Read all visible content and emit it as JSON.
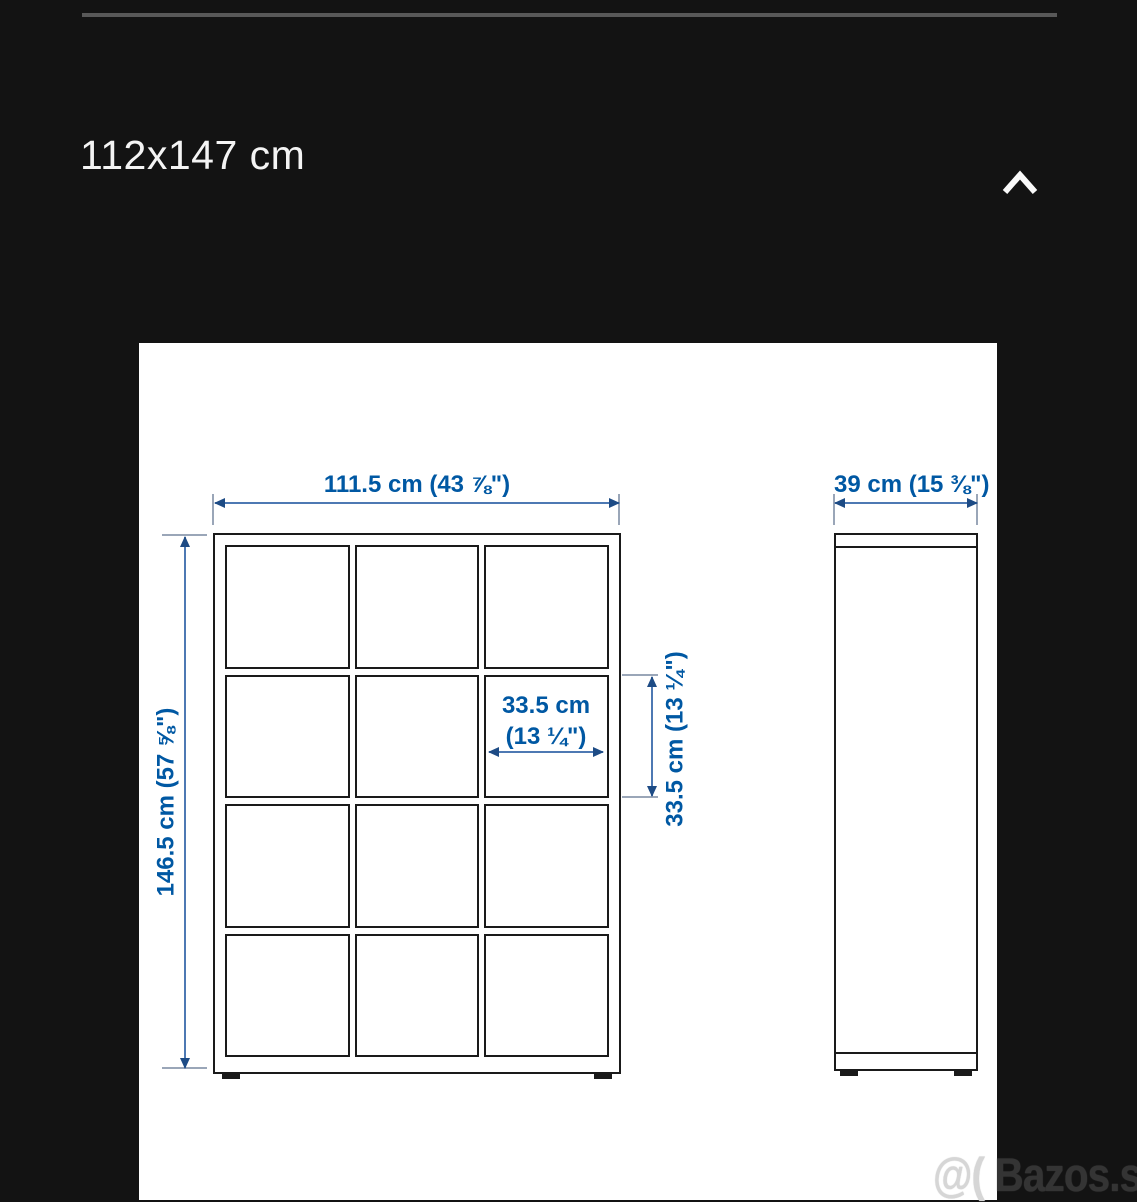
{
  "page": {
    "background_color": "#131313",
    "size_label": "112x147 cm"
  },
  "toolbar": {
    "collapse_icon": "chevron-up"
  },
  "diagram": {
    "dimension_text_color": "#0058a3",
    "drawing_line_color": "#1a1a1a",
    "front_view": {
      "columns": 3,
      "rows": 4,
      "width_label": "111.5 cm (43 ⅞\")",
      "height_label": "146.5 cm (57 ⅝\")",
      "cell_width_label_line1": "33.5 cm",
      "cell_width_label_line2": "(13 ¼\")",
      "cell_height_label": "33.5 cm (13 ¼\")"
    },
    "side_view": {
      "depth_label": "39 cm (15 ⅜\")"
    }
  },
  "watermark": {
    "prefix": "@( ",
    "site": "Bazos.sk"
  }
}
